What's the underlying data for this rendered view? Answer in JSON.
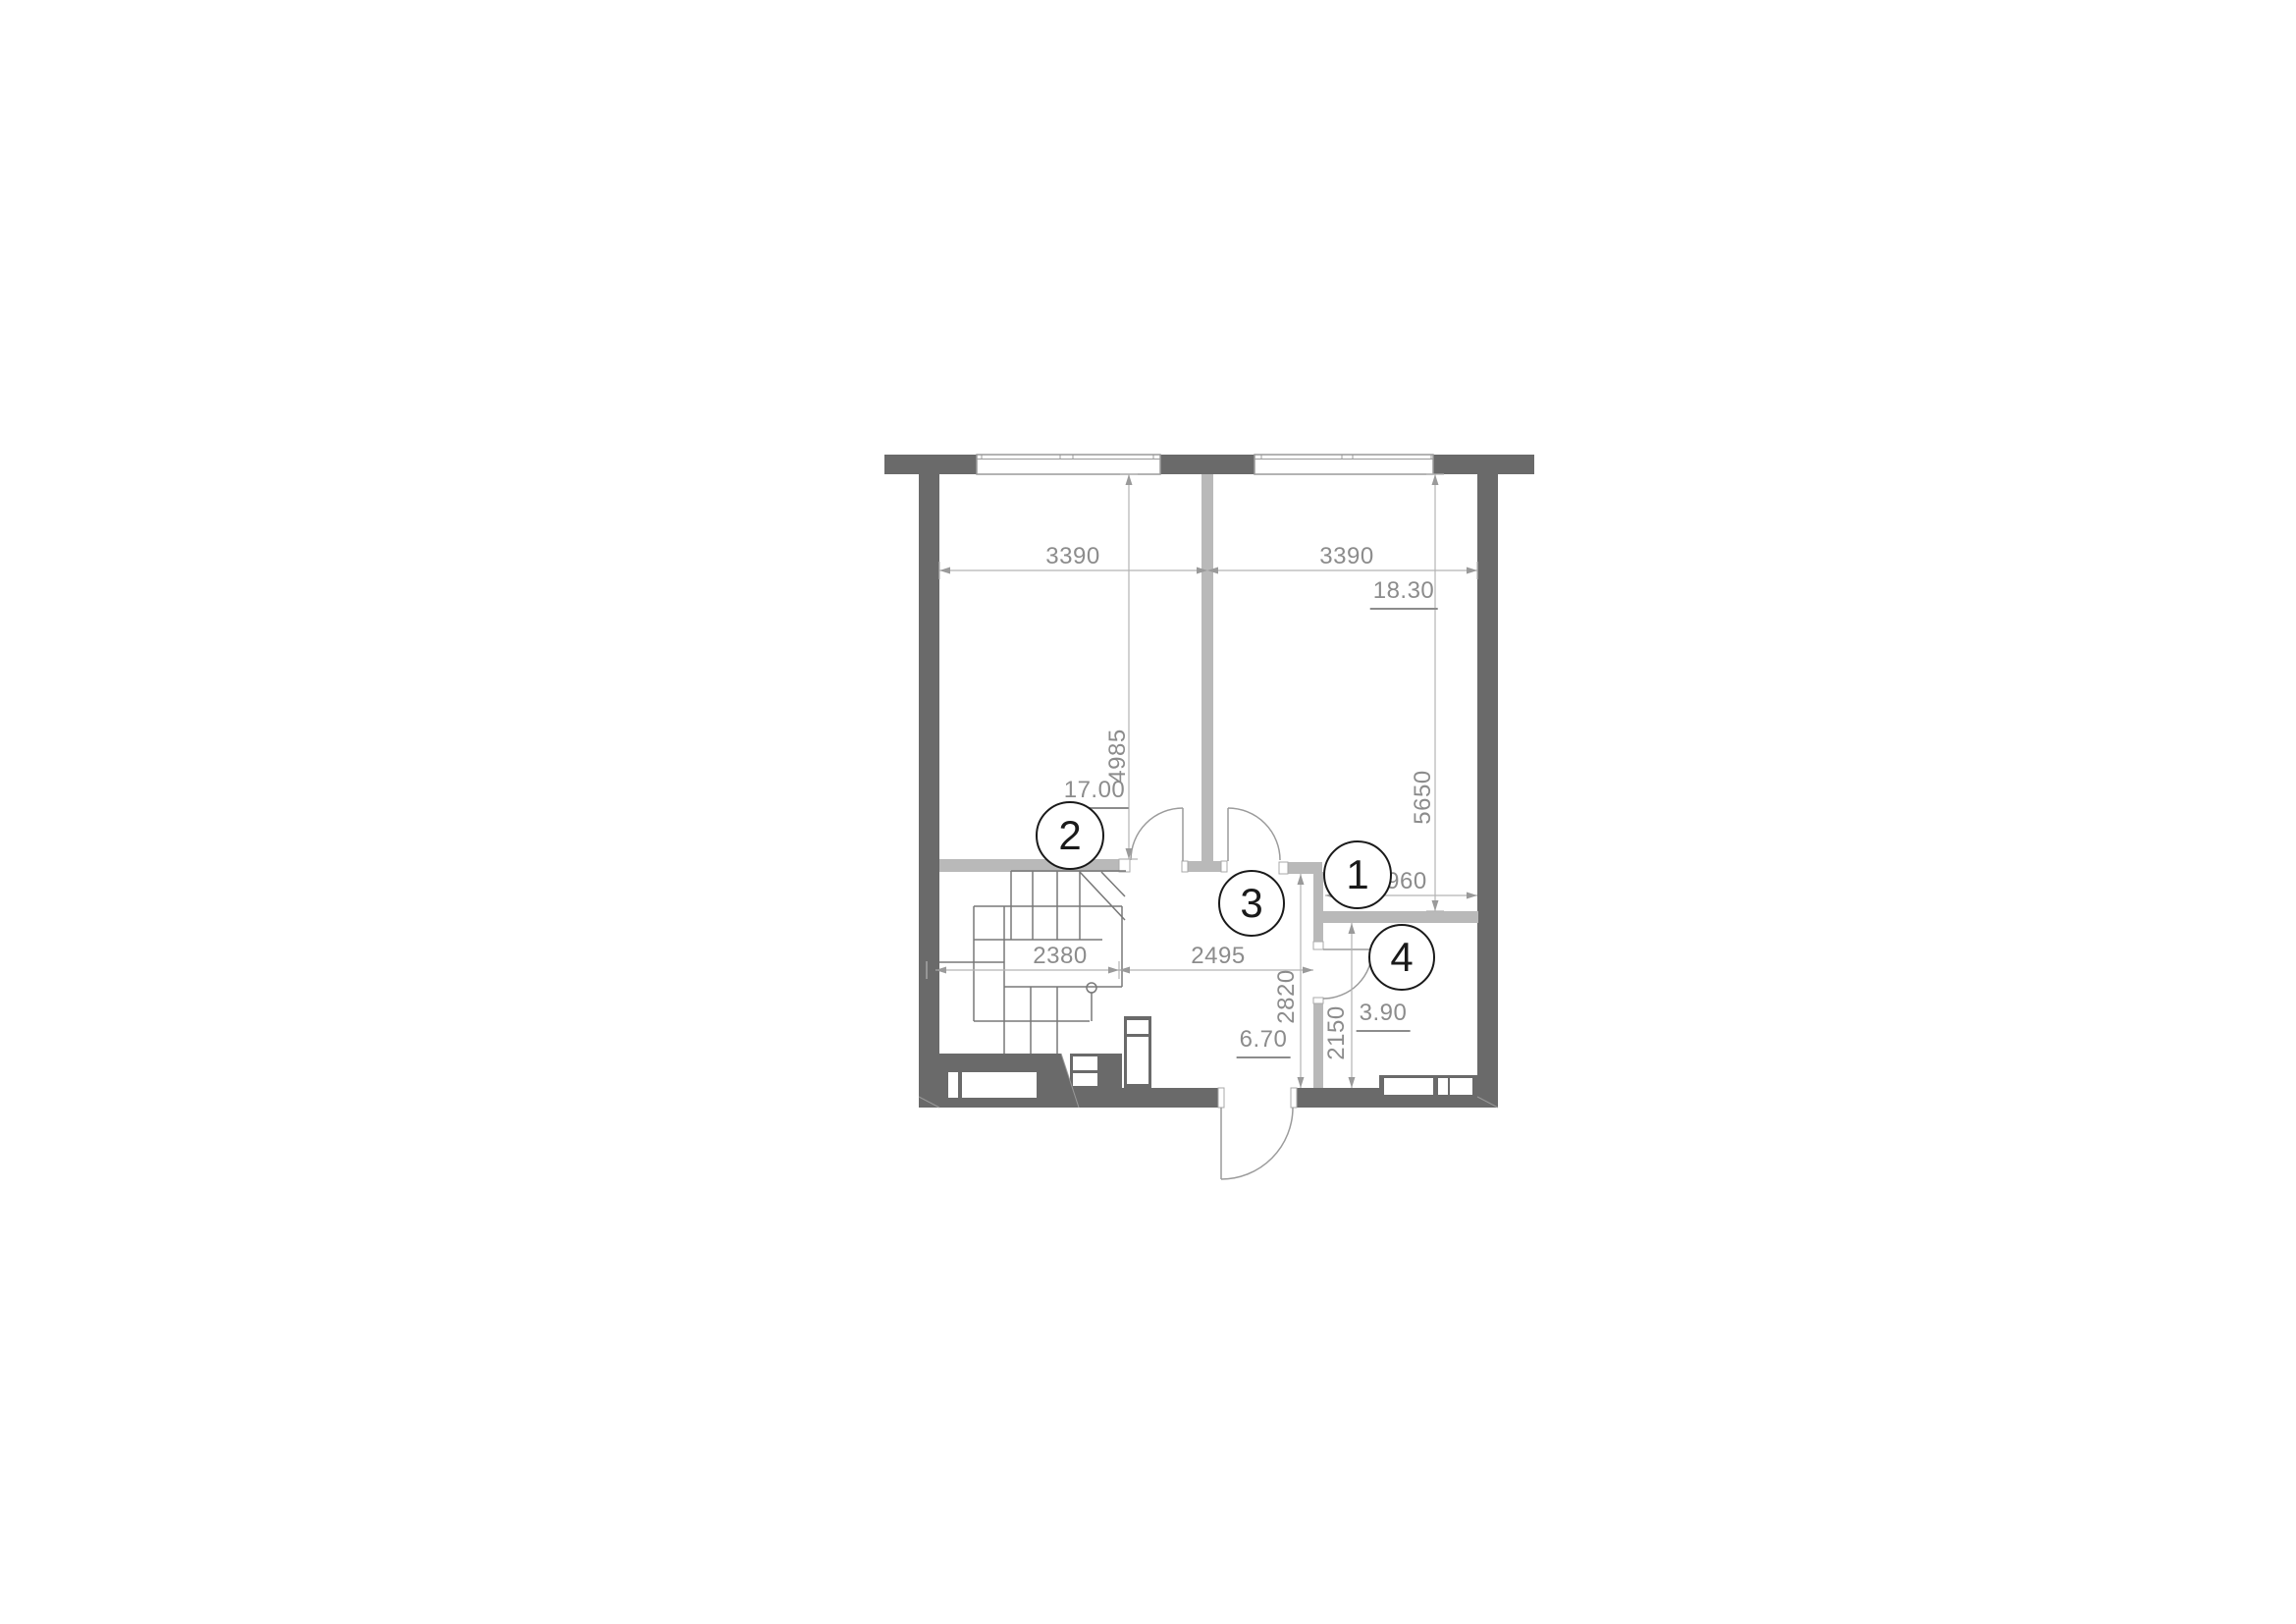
{
  "drawing_type": "apartment floor plan",
  "rooms": [
    {
      "id": "1",
      "area": "18.30"
    },
    {
      "id": "2",
      "area": "17.00"
    },
    {
      "id": "3",
      "area": "6.70"
    },
    {
      "id": "4",
      "area": "3.90"
    }
  ],
  "dims": {
    "top_left_width": "3390",
    "top_right_width": "3390",
    "room2_height": "4985",
    "room1_height": "5650",
    "stairs_width": "2380",
    "hall_width": "2495",
    "hall_height": "2820",
    "bath_height": "2150",
    "alcove_width": "1960"
  },
  "colors": {
    "exterior_wall": "#6a6a6a",
    "interior_partition": "#b9b9b9",
    "dimension_line": "#b4b4b4",
    "dimension_text": "#8c8c8c",
    "door_arc": "#9b9b9b",
    "stair_line": "#787878",
    "room_circle_stroke": "#1a1a1a"
  }
}
